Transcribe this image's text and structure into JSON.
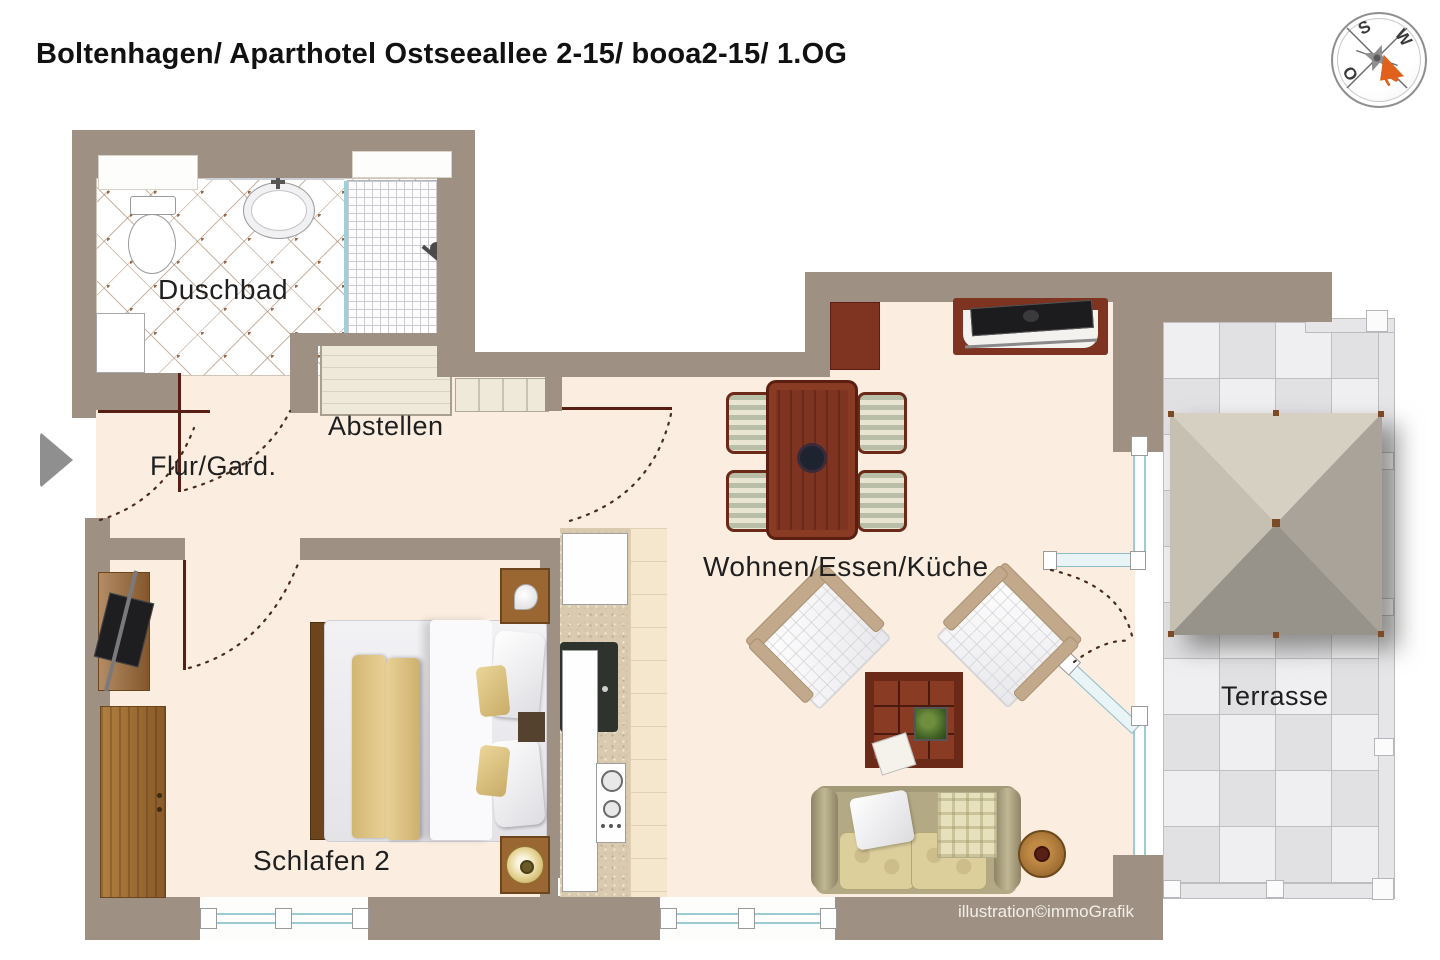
{
  "title": "Boltenhagen/ Aparthotel Ostseeallee 2-15/ booa2-15/ 1.OG",
  "watermark": "illustration©immoGrafik",
  "compass": {
    "n": "N",
    "o": "O",
    "s": "S",
    "w": "W",
    "needle_color": "#e0611c"
  },
  "rooms": {
    "duschbad": {
      "label": "Duschbad"
    },
    "abstellen": {
      "label": "Abstellen"
    },
    "flur": {
      "label": "Flur/Gard."
    },
    "schlafen": {
      "label": "Schlafen 2"
    },
    "wohnen": {
      "label": "Wohnen/Essen/Küche"
    },
    "terrasse": {
      "label": "Terrasse"
    }
  },
  "colors": {
    "wall": "#9e9183",
    "floor": "#fbeee1",
    "furniture_red": "#7e3420",
    "furniture_wood": "#9a6632",
    "glass": "#9ccbd6",
    "bed_blanket": "#dfc183",
    "sofa": "#b3aa85",
    "compass_needle": "#e0611c"
  }
}
